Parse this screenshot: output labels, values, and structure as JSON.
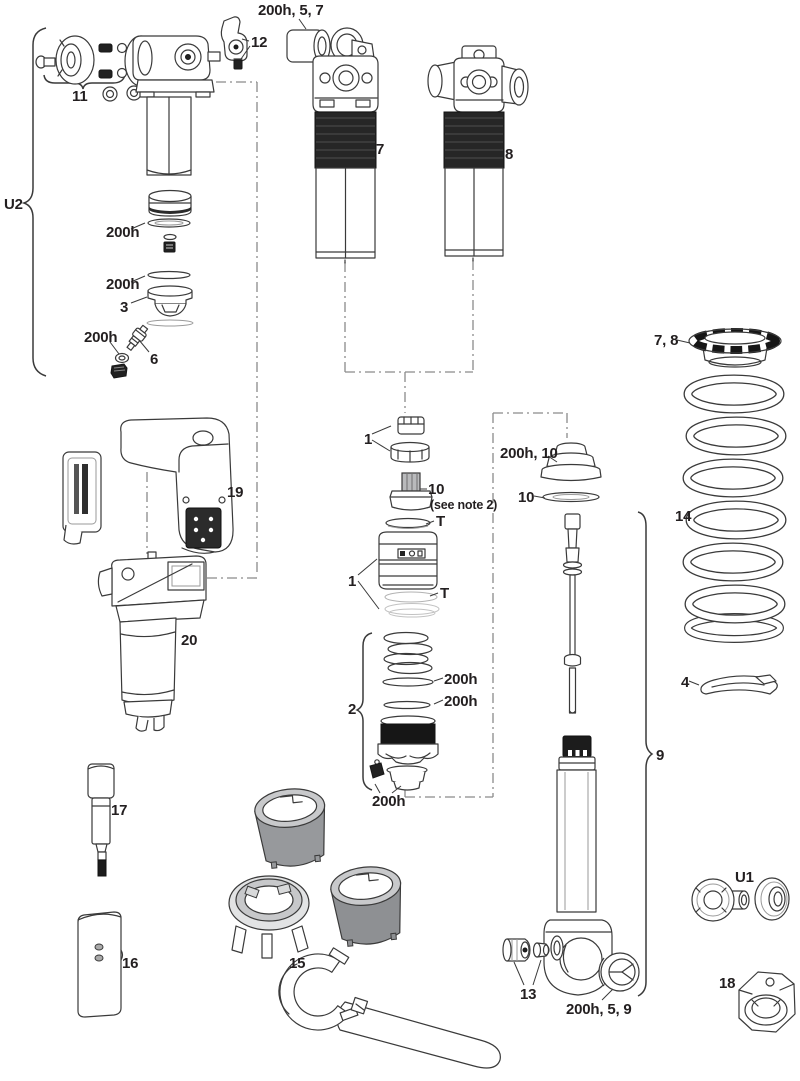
{
  "meta": {
    "figure_type": "exploded parts diagram",
    "subject": "rear shock absorber service parts with numbered callouts",
    "colors": {
      "background": "#ffffff",
      "line": "#3a3a3a",
      "dark_fill": "#212121",
      "gray_sleeve": "#97999c",
      "label_text": "#231f20"
    }
  },
  "callouts": [
    {
      "id": "seal-kit-top",
      "text": "200h, 5, 7"
    },
    {
      "id": "part-12",
      "text": "12"
    },
    {
      "id": "part-11",
      "text": "11"
    },
    {
      "id": "group-u2",
      "text": "U2"
    },
    {
      "id": "part-7",
      "text": "7"
    },
    {
      "id": "part-8",
      "text": "8"
    },
    {
      "id": "seal-200h-a",
      "text": "200h"
    },
    {
      "id": "seal-200h-b",
      "text": "200h"
    },
    {
      "id": "part-3",
      "text": "3"
    },
    {
      "id": "seal-200h-c",
      "text": "200h"
    },
    {
      "id": "part-6",
      "text": "6"
    },
    {
      "id": "collar-7-8",
      "text": "7, 8"
    },
    {
      "id": "part-14",
      "text": "14"
    },
    {
      "id": "part-1-upper",
      "text": "1"
    },
    {
      "id": "part-10-valve",
      "text": "10"
    },
    {
      "id": "note-2-ref",
      "text": "(see note 2)"
    },
    {
      "id": "t-seal-upper",
      "text": "T"
    },
    {
      "id": "seal-200h-10",
      "text": "200h, 10"
    },
    {
      "id": "part-10-ring",
      "text": "10"
    },
    {
      "id": "part-1-lower",
      "text": "1"
    },
    {
      "id": "t-seal-lower",
      "text": "T"
    },
    {
      "id": "group-2",
      "text": "2"
    },
    {
      "id": "seal-200h-d",
      "text": "200h"
    },
    {
      "id": "seal-200h-e",
      "text": "200h"
    },
    {
      "id": "seal-200h-f",
      "text": "200h"
    },
    {
      "id": "part-4",
      "text": "4"
    },
    {
      "id": "group-9",
      "text": "9"
    },
    {
      "id": "part-19",
      "text": "19"
    },
    {
      "id": "part-20",
      "text": "20"
    },
    {
      "id": "part-17",
      "text": "17"
    },
    {
      "id": "part-16",
      "text": "16"
    },
    {
      "id": "part-15",
      "text": "15"
    },
    {
      "id": "part-13",
      "text": "13"
    },
    {
      "id": "seal-200h-5-9",
      "text": "200h, 5, 9"
    },
    {
      "id": "group-u1",
      "text": "U1"
    },
    {
      "id": "part-18",
      "text": "18"
    }
  ]
}
